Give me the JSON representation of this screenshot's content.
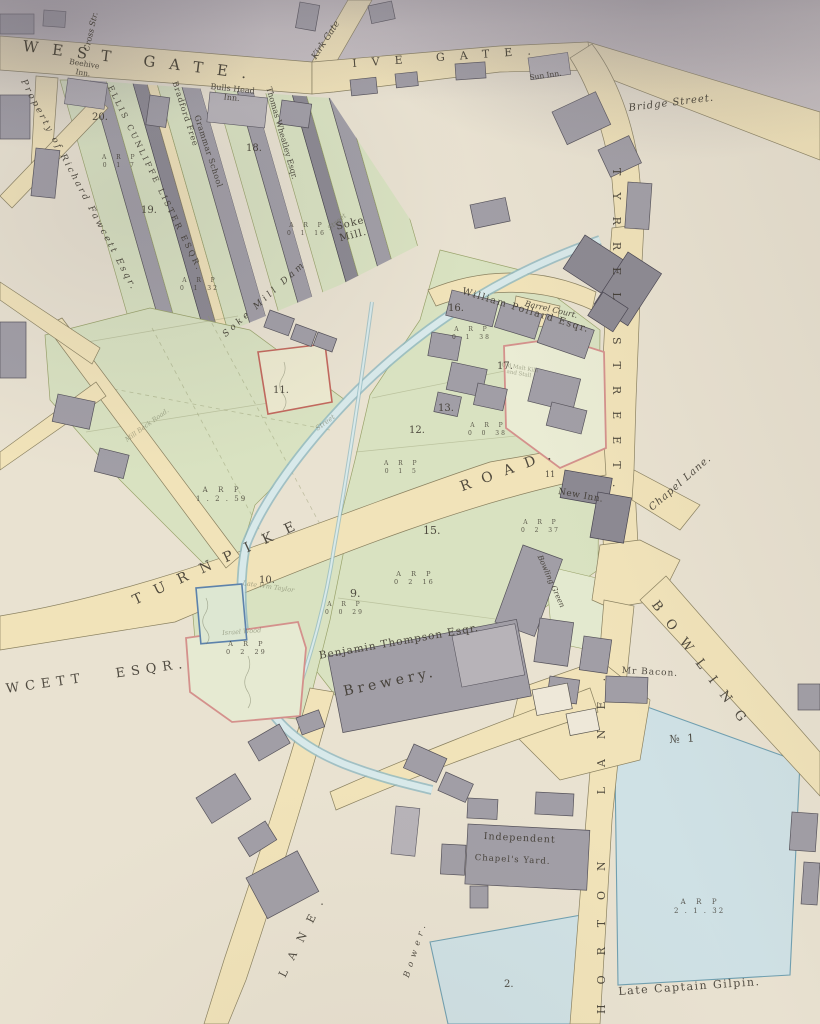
{
  "map": {
    "colors": {
      "paper": "#e9e2d1",
      "paper_dark": "#bfb9c1",
      "road": "#f1e3b9",
      "road_edge": "#8a8160",
      "green": "#d9e2c1",
      "green2": "#e3e9cf",
      "water": "#8fb8c0",
      "water_light": "#d8e9ea",
      "building": "#a19ea6",
      "building_dark": "#8c8992",
      "building_light": "#b7b3b8",
      "white_bld": "#eee8d9",
      "blue_field": "#cfe1e5",
      "blue_edge": "#6f9fb0",
      "plot_red": "#c2685d",
      "plot_pink": "#d4918c",
      "plot_blue": "#5d82ab",
      "ink": "#3c372e",
      "faint": "#6e7258"
    },
    "labels": [
      {
        "id": "west-gate",
        "t": "WEST GATE.",
        "x": 24,
        "y": 38,
        "s": 15,
        "r": 7,
        "ls": 14
      },
      {
        "id": "ive-gate",
        "t": "IVE GATE.",
        "x": 352,
        "y": 58,
        "s": 11,
        "r": -4,
        "ls": 15
      },
      {
        "id": "kirk-gate",
        "t": "Kirk Gate",
        "x": 310,
        "y": 56,
        "s": 9,
        "r": -57,
        "cls": "it"
      },
      {
        "id": "cross-street",
        "t": "Cross Str.",
        "x": 82,
        "y": 50,
        "s": 8,
        "r": -77,
        "cls": "it"
      },
      {
        "id": "bridge-street",
        "t": "Bridge Street.",
        "x": 628,
        "y": 103,
        "s": 10,
        "r": -7,
        "ls": 1,
        "cls": "it"
      },
      {
        "id": "sun-inn",
        "t": "Sun Inn.",
        "x": 529,
        "y": 74,
        "s": 7.5,
        "r": -8
      },
      {
        "id": "tyrrel-street",
        "t": "TYRREL STREET.",
        "x": 622,
        "y": 168,
        "s": 11,
        "r": 90,
        "ls": 17
      },
      {
        "id": "turnpike",
        "t": "TURNPIKE",
        "x": 130,
        "y": 594,
        "s": 14,
        "r": -25,
        "ls": 14
      },
      {
        "id": "road",
        "t": "ROAD.",
        "x": 458,
        "y": 480,
        "s": 14,
        "r": -20,
        "ls": 12
      },
      {
        "id": "chapel-lane",
        "t": "Chapel Lane.",
        "x": 647,
        "y": 505,
        "s": 10,
        "r": -41,
        "ls": 1,
        "cls": "it"
      },
      {
        "id": "bowling",
        "t": "BOWLING",
        "x": 660,
        "y": 598,
        "s": 13,
        "r": 53,
        "ls": 13
      },
      {
        "id": "horton-lane",
        "t": "HORTON  LANE.",
        "x": 596,
        "y": 1014,
        "s": 11,
        "r": -90,
        "ls": 20
      },
      {
        "id": "lane-sw",
        "t": "LANE.",
        "x": 277,
        "y": 974,
        "s": 11,
        "r": -63,
        "ls": 12
      },
      {
        "id": "bower",
        "t": "Bower.",
        "x": 402,
        "y": 976,
        "s": 8.5,
        "r": -72,
        "ls": 5,
        "cls": "it"
      },
      {
        "id": "beck-road",
        "t": "Mill Beck Road.",
        "x": 124,
        "y": 438,
        "s": 6.5,
        "r": -36,
        "cls": "it faint"
      },
      {
        "id": "beehive-inn",
        "t": "Beehive\nInn.",
        "x": 70,
        "y": 58,
        "s": 7.5,
        "r": 9,
        "ta": "center"
      },
      {
        "id": "bulls-head-inn",
        "t": "Bulls Head\nInn.",
        "x": 211,
        "y": 82,
        "s": 8,
        "r": 6,
        "ta": "center"
      },
      {
        "id": "property-fawcett",
        "t": "Property of Richard Fawcett Esqr.",
        "x": 27,
        "y": 78,
        "s": 9,
        "r": 62,
        "ls": 2.5,
        "cls": "it"
      },
      {
        "id": "lister",
        "t": "ELLIS CUNLIFFE LISTER ESQR.",
        "x": 114,
        "y": 84,
        "s": 8,
        "r": 64,
        "ls": 2.6
      },
      {
        "id": "grammar-1",
        "t": "Bradford Free",
        "x": 179,
        "y": 80,
        "s": 8,
        "r": 72,
        "ls": 0.8
      },
      {
        "id": "grammar-2",
        "t": "Grammar School",
        "x": 201,
        "y": 114,
        "s": 8,
        "r": 72,
        "ls": 0.5
      },
      {
        "id": "wheatley",
        "t": "Thomas Wheatley Esqr.",
        "x": 273,
        "y": 86,
        "s": 8,
        "r": 74
      },
      {
        "id": "soke-mill-dam",
        "t": "Soke Mill Dam",
        "x": 221,
        "y": 332,
        "s": 9,
        "r": -42,
        "ls": 3.2,
        "cls": "it"
      },
      {
        "id": "soke-mill",
        "t": "Soke\nMill.",
        "x": 335,
        "y": 222,
        "s": 10,
        "r": -14,
        "ls": 1,
        "ta": "center"
      },
      {
        "id": "pollard",
        "t": "William Pollard Esqr.",
        "x": 464,
        "y": 286,
        "s": 9.5,
        "r": 17,
        "ls": 1.5
      },
      {
        "id": "barrel-court",
        "t": "Barrel Court.",
        "x": 526,
        "y": 299,
        "s": 8,
        "r": 13,
        "cls": "it"
      },
      {
        "id": "new-inn",
        "t": "New Inn.",
        "x": 559,
        "y": 487,
        "s": 9,
        "r": 10,
        "ls": 0.5
      },
      {
        "id": "bowling-green",
        "t": "Bowling Green",
        "x": 543,
        "y": 554,
        "s": 7.5,
        "r": 66,
        "cls": "it"
      },
      {
        "id": "thompson",
        "t": "Benjamin Thompson Esqr.",
        "x": 318,
        "y": 650,
        "s": 10.5,
        "r": -10,
        "ls": 1
      },
      {
        "id": "brewery",
        "t": "Brewery.",
        "x": 342,
        "y": 684,
        "s": 14,
        "r": -12,
        "ls": 4
      },
      {
        "id": "bacon",
        "t": "Mr Bacon.",
        "x": 622,
        "y": 666,
        "s": 9,
        "r": 3,
        "ls": 1
      },
      {
        "id": "no-1",
        "t": "№ 1",
        "x": 669,
        "y": 734,
        "s": 11,
        "r": -3,
        "ls": 2
      },
      {
        "id": "gilpin",
        "t": "Late Captain Gilpin.",
        "x": 618,
        "y": 986,
        "s": 11,
        "r": -4,
        "ls": 1.5
      },
      {
        "id": "independent",
        "t": "Independent",
        "x": 484,
        "y": 831,
        "s": 9.5,
        "r": 3,
        "ls": 1
      },
      {
        "id": "chapels-yard",
        "t": "Chapel's Yard.",
        "x": 475,
        "y": 853,
        "s": 8.5,
        "r": 3,
        "ls": 1
      },
      {
        "id": "fawcett-esq",
        "t": "WCETT   ESQR.",
        "x": 5,
        "y": 682,
        "s": 13,
        "r": -8,
        "ls": 6
      },
      {
        "id": "malt-kiln",
        "t": "Old Malt Kiln\nand Stall",
        "x": 502,
        "y": 362,
        "s": 5.5,
        "r": 10,
        "ta": "center",
        "cls": "faint"
      },
      {
        "id": "late-taylor",
        "t": "Late Wm Taylor",
        "x": 243,
        "y": 580,
        "s": 6.5,
        "r": 8,
        "cls": "it faint"
      },
      {
        "id": "israel-wood",
        "t": "Israel Wood",
        "x": 222,
        "y": 630,
        "s": 6.5,
        "r": -4,
        "cls": "it faint"
      },
      {
        "id": "street-pencil-1",
        "t": "Street",
        "x": 314,
        "y": 426,
        "s": 7,
        "r": -36,
        "cls": "it faint"
      },
      {
        "id": "street-pencil-2",
        "t": "Street",
        "x": 326,
        "y": 226,
        "s": 7,
        "r": -40,
        "cls": "it faint"
      },
      {
        "id": "plot-20",
        "t": "20.",
        "x": 92,
        "y": 112,
        "s": 10
      },
      {
        "id": "plot-19",
        "t": "19.",
        "x": 141,
        "y": 205,
        "s": 10
      },
      {
        "id": "plot-18",
        "t": "18.",
        "x": 246,
        "y": 143,
        "s": 10
      },
      {
        "id": "plot-16",
        "t": "16.",
        "x": 448,
        "y": 303,
        "s": 10
      },
      {
        "id": "plot-17",
        "t": "17.",
        "x": 497,
        "y": 361,
        "s": 10
      },
      {
        "id": "plot-13",
        "t": "13.",
        "x": 438,
        "y": 403,
        "s": 10
      },
      {
        "id": "plot-12",
        "t": "12.",
        "x": 409,
        "y": 425,
        "s": 10
      },
      {
        "id": "plot-11",
        "t": "11.",
        "x": 273,
        "y": 385,
        "s": 10
      },
      {
        "id": "plot-11b",
        "t": "11",
        "x": 545,
        "y": 470,
        "s": 8
      },
      {
        "id": "plot-15",
        "t": "15.",
        "x": 423,
        "y": 525,
        "s": 11
      },
      {
        "id": "plot-10",
        "t": "10.",
        "x": 259,
        "y": 575,
        "s": 10
      },
      {
        "id": "plot-9",
        "t": "9.",
        "x": 350,
        "y": 588,
        "s": 11
      },
      {
        "id": "plot-2",
        "t": "2.",
        "x": 504,
        "y": 979,
        "s": 10
      },
      {
        "id": "arp-20",
        "t": "A  R  P\n0  1  7",
        "x": 102,
        "y": 154,
        "s": 6,
        "cls": "arp"
      },
      {
        "id": "arp-19",
        "t": "A  R  P\n0  1  32",
        "x": 180,
        "y": 277,
        "s": 6,
        "cls": "arp"
      },
      {
        "id": "arp-18",
        "t": "A  R  P\n0  1  16",
        "x": 287,
        "y": 222,
        "s": 6,
        "cls": "arp"
      },
      {
        "id": "arp-16",
        "t": "A  R  P\n0  1  38",
        "x": 452,
        "y": 326,
        "s": 6,
        "cls": "arp"
      },
      {
        "id": "arp-17",
        "t": "A  R  P\n0  0  38",
        "x": 468,
        "y": 422,
        "s": 6,
        "cls": "arp"
      },
      {
        "id": "arp-13",
        "t": "A  R  P\n0  1  5",
        "x": 384,
        "y": 460,
        "s": 6,
        "cls": "arp"
      },
      {
        "id": "arp-15",
        "t": "A  R  P\n0  2  16",
        "x": 394,
        "y": 570,
        "s": 6.5,
        "cls": "arp"
      },
      {
        "id": "arp-9",
        "t": "A  R  P\n0  0  29",
        "x": 325,
        "y": 601,
        "s": 6,
        "cls": "arp"
      },
      {
        "id": "arp-new-inn",
        "t": "A  R  P\n0  2  37",
        "x": 521,
        "y": 519,
        "s": 6,
        "cls": "arp"
      },
      {
        "id": "arp-10",
        "t": "A  R  P\n0  2  29",
        "x": 226,
        "y": 640,
        "s": 6.5,
        "cls": "arp"
      },
      {
        "id": "arp-14",
        "t": "A  R  P\n1 . 2 . 59",
        "x": 196,
        "y": 486,
        "s": 7,
        "cls": "arp"
      },
      {
        "id": "arp-no-1",
        "t": "A  R  P\n2 . 1 . 32",
        "x": 674,
        "y": 898,
        "s": 7,
        "cls": "arp"
      }
    ]
  }
}
